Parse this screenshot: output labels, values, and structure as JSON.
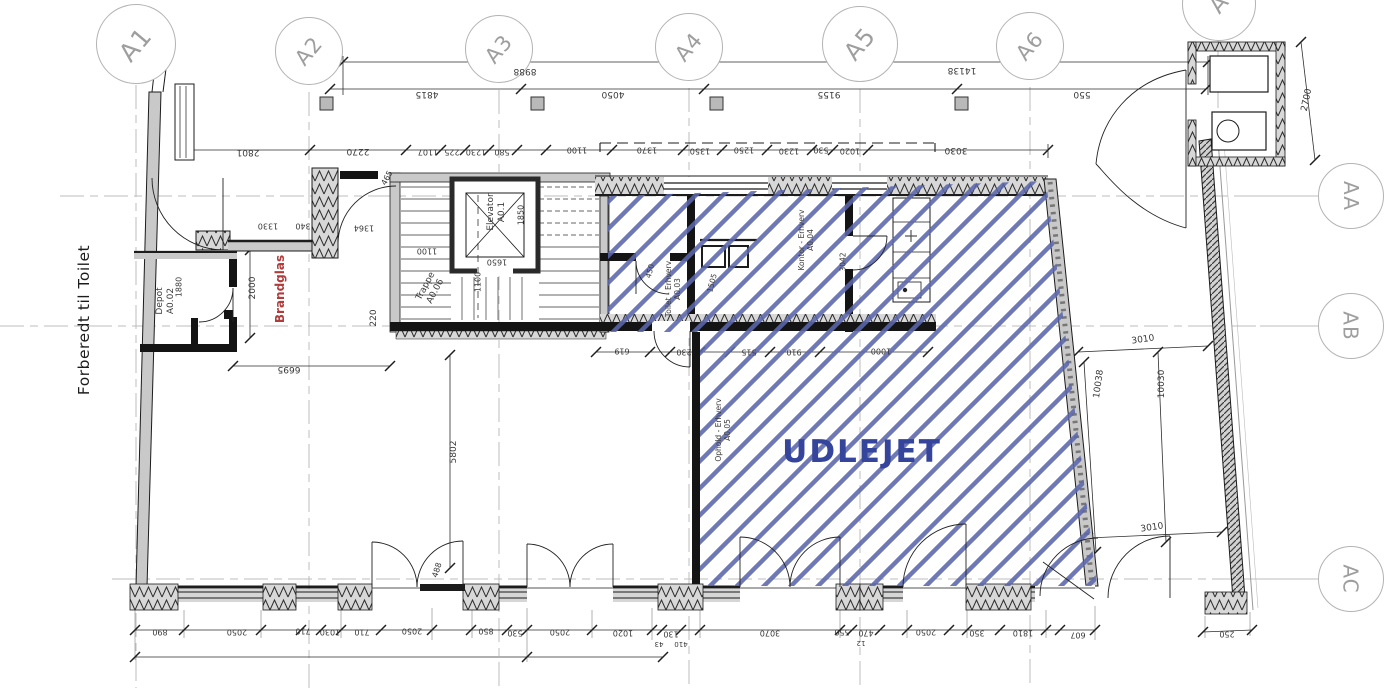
{
  "annotations": {
    "udlejet": "UDLEJET",
    "forberedt_til_toilet": "Forberedt til Toilet",
    "brandglas": "Brandglas"
  },
  "grid_bubbles": {
    "top": [
      {
        "label": "A1",
        "x": 136,
        "y": 44,
        "r": 40
      },
      {
        "label": "A2",
        "x": 309,
        "y": 51,
        "r": 34
      },
      {
        "label": "A3",
        "x": 499,
        "y": 49,
        "r": 34
      },
      {
        "label": "A4",
        "x": 689,
        "y": 47,
        "r": 34
      },
      {
        "label": "A5",
        "x": 860,
        "y": 44,
        "r": 38
      },
      {
        "label": "A6",
        "x": 1030,
        "y": 46,
        "r": 34
      }
    ],
    "right": [
      {
        "label": "AA",
        "x": 1351,
        "y": 196,
        "r": 33
      },
      {
        "label": "AB",
        "x": 1351,
        "y": 326,
        "r": 33
      },
      {
        "label": "AC",
        "x": 1351,
        "y": 579,
        "r": 33
      }
    ],
    "partial": {
      "label": "A",
      "x": 1219,
      "y": 4,
      "r": 37
    }
  },
  "room_labels": [
    {
      "lines": [
        "Depot",
        "A0.02"
      ],
      "x": 166,
      "y": 301,
      "rot": -90,
      "size": 9
    },
    {
      "lines": [
        "Trappe",
        "A0.06"
      ],
      "x": 431,
      "y": 289,
      "rot": -62,
      "size": 9
    },
    {
      "lines": [
        "Elevator",
        "A0.1"
      ],
      "x": 497,
      "y": 212,
      "rot": -90,
      "size": 9
    },
    {
      "lines": [
        "Toilet - Erhverv",
        "A0.03"
      ],
      "x": 673,
      "y": 289,
      "rot": -90,
      "size": 7.5
    },
    {
      "lines": [
        "Kontor - Erhverv",
        "A0.04"
      ],
      "x": 806,
      "y": 240,
      "rot": -90,
      "size": 7.5
    },
    {
      "lines": [
        "Ophold - Erhverv",
        "A0.05"
      ],
      "x": 723,
      "y": 430,
      "rot": -90,
      "size": 7.5
    }
  ],
  "dimensions": [
    {
      "t": "8988",
      "x": 525,
      "y": 71,
      "r": 180
    },
    {
      "t": "14138",
      "x": 962,
      "y": 70,
      "r": 180
    },
    {
      "t": "4815",
      "x": 427,
      "y": 94,
      "r": 180
    },
    {
      "t": "4050",
      "x": 613,
      "y": 94,
      "r": 180
    },
    {
      "t": "9155",
      "x": 829,
      "y": 94,
      "r": 180
    },
    {
      "t": "550",
      "x": 1082,
      "y": 94,
      "r": 180
    },
    {
      "t": "2801",
      "x": 248,
      "y": 152,
      "r": 180
    },
    {
      "t": "2270",
      "x": 358,
      "y": 151,
      "r": 180
    },
    {
      "t": "1107",
      "x": 428,
      "y": 152,
      "r": 180,
      "s": 8
    },
    {
      "t": "225",
      "x": 452,
      "y": 152,
      "r": 180,
      "s": 8
    },
    {
      "t": "1230",
      "x": 476,
      "y": 152,
      "r": 180,
      "s": 8
    },
    {
      "t": "580",
      "x": 502,
      "y": 152,
      "r": 180,
      "s": 8
    },
    {
      "t": "1100",
      "x": 577,
      "y": 150,
      "r": 180,
      "s": 8
    },
    {
      "t": "1370",
      "x": 647,
      "y": 150,
      "r": 180,
      "s": 8
    },
    {
      "t": "1350",
      "x": 700,
      "y": 151,
      "r": 180,
      "s": 8
    },
    {
      "t": "1250",
      "x": 744,
      "y": 150,
      "r": 180,
      "s": 8
    },
    {
      "t": "1230",
      "x": 789,
      "y": 151,
      "r": 180,
      "s": 8
    },
    {
      "t": "530",
      "x": 821,
      "y": 150,
      "r": 180,
      "s": 8
    },
    {
      "t": "1020",
      "x": 850,
      "y": 151,
      "r": 180,
      "s": 8
    },
    {
      "t": "3030",
      "x": 956,
      "y": 150,
      "r": 180
    },
    {
      "t": "1330",
      "x": 268,
      "y": 226,
      "r": 180,
      "s": 8
    },
    {
      "t": "340",
      "x": 303,
      "y": 226,
      "r": 180,
      "s": 8
    },
    {
      "t": "1364",
      "x": 364,
      "y": 228,
      "r": 180,
      "s": 8
    },
    {
      "t": "465",
      "x": 387,
      "y": 178,
      "r": -62,
      "s": 8
    },
    {
      "t": "2000",
      "x": 253,
      "y": 288,
      "r": -90
    },
    {
      "t": "1880",
      "x": 179,
      "y": 287,
      "r": -90,
      "s": 8
    },
    {
      "t": "6695",
      "x": 289,
      "y": 369,
      "r": 180
    },
    {
      "t": "220",
      "x": 374,
      "y": 318,
      "r": -90
    },
    {
      "t": "5802",
      "x": 454,
      "y": 452,
      "r": -90
    },
    {
      "t": "488",
      "x": 437,
      "y": 570,
      "r": -72,
      "s": 8
    },
    {
      "t": "1850",
      "x": 521,
      "y": 215,
      "r": -90,
      "s": 8
    },
    {
      "t": "1650",
      "x": 497,
      "y": 262,
      "r": 180,
      "s": 8
    },
    {
      "t": "1100",
      "x": 427,
      "y": 251,
      "r": 180,
      "s": 8
    },
    {
      "t": "1100",
      "x": 478,
      "y": 282,
      "r": -90,
      "s": 8
    },
    {
      "t": "450",
      "x": 650,
      "y": 271,
      "r": -75,
      "s": 7.5
    },
    {
      "t": "1505",
      "x": 712,
      "y": 283,
      "r": -75,
      "s": 7.5
    },
    {
      "t": "3042",
      "x": 843,
      "y": 262,
      "r": -90,
      "s": 7.5
    },
    {
      "t": "619",
      "x": 622,
      "y": 351,
      "r": 180,
      "s": 8
    },
    {
      "t": "230",
      "x": 684,
      "y": 352,
      "r": 180,
      "s": 8
    },
    {
      "t": "515",
      "x": 749,
      "y": 352,
      "r": 180,
      "s": 8
    },
    {
      "t": "910",
      "x": 794,
      "y": 352,
      "r": 180,
      "s": 8
    },
    {
      "t": "1000",
      "x": 881,
      "y": 351,
      "r": 180,
      "s": 8
    },
    {
      "t": "3010",
      "x": 1143,
      "y": 340,
      "r": -8
    },
    {
      "t": "10038",
      "x": 1099,
      "y": 384,
      "r": -82
    },
    {
      "t": "10030",
      "x": 1162,
      "y": 384,
      "r": -90
    },
    {
      "t": "3010",
      "x": 1152,
      "y": 528,
      "r": -8
    },
    {
      "t": "2700",
      "x": 1307,
      "y": 100,
      "r": -78
    },
    {
      "t": "890",
      "x": 160,
      "y": 632,
      "r": 180,
      "s": 8
    },
    {
      "t": "2050",
      "x": 237,
      "y": 632,
      "r": 180,
      "s": 8
    },
    {
      "t": "710",
      "x": 303,
      "y": 631,
      "r": 180,
      "s": 8
    },
    {
      "t": "1030",
      "x": 330,
      "y": 632,
      "r": 180,
      "s": 8
    },
    {
      "t": "710",
      "x": 362,
      "y": 632,
      "r": 180,
      "s": 8
    },
    {
      "t": "2050",
      "x": 412,
      "y": 631,
      "r": 180,
      "s": 8
    },
    {
      "t": "850",
      "x": 486,
      "y": 631,
      "r": 180,
      "s": 8
    },
    {
      "t": "530",
      "x": 515,
      "y": 633,
      "r": 180,
      "s": 8
    },
    {
      "t": "2050",
      "x": 560,
      "y": 632,
      "r": 180,
      "s": 8
    },
    {
      "t": "1020",
      "x": 623,
      "y": 633,
      "r": 180,
      "s": 8
    },
    {
      "t": "130",
      "x": 671,
      "y": 634,
      "r": 180,
      "s": 8
    },
    {
      "t": "43",
      "x": 659,
      "y": 644,
      "r": 180,
      "s": 7
    },
    {
      "t": "410",
      "x": 681,
      "y": 644,
      "r": 180,
      "s": 7
    },
    {
      "t": "3070",
      "x": 770,
      "y": 633,
      "r": 180,
      "s": 8
    },
    {
      "t": "550",
      "x": 842,
      "y": 632,
      "r": 180,
      "s": 8
    },
    {
      "t": "470",
      "x": 866,
      "y": 633,
      "r": 180,
      "s": 8
    },
    {
      "t": "12",
      "x": 861,
      "y": 643,
      "r": 180,
      "s": 7
    },
    {
      "t": "2050",
      "x": 926,
      "y": 632,
      "r": 180,
      "s": 8
    },
    {
      "t": "350",
      "x": 977,
      "y": 633,
      "r": 180,
      "s": 8
    },
    {
      "t": "1810",
      "x": 1023,
      "y": 633,
      "r": 180,
      "s": 8
    },
    {
      "t": "607",
      "x": 1078,
      "y": 635,
      "r": 180,
      "s": 8
    },
    {
      "t": "250",
      "x": 1227,
      "y": 634,
      "r": 180,
      "s": 8
    }
  ],
  "colors": {
    "hatch": "#5a66ab",
    "udlejet_text": "#36459c",
    "brandglas": "#b03c3c",
    "wall_gray": "#c9c9c9",
    "line_black": "#1c1c1c",
    "grid_gray": "#bcbcbc",
    "dim_text": "#383838",
    "bubble_text": "#9e9e9e"
  }
}
